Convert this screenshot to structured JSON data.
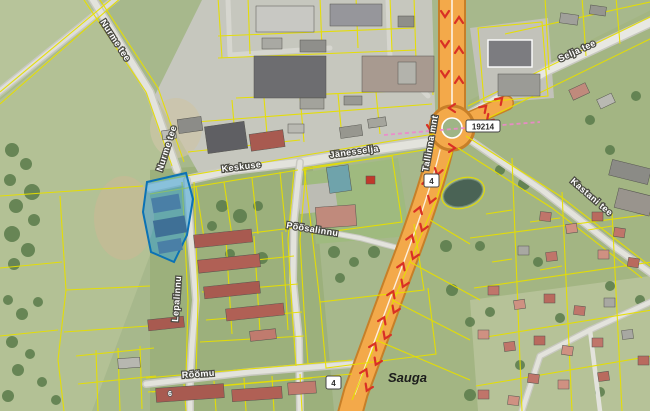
{
  "map": {
    "place_labels": {
      "sauga": "Sauga"
    },
    "streets": {
      "nurme_tee": "Nurme tee",
      "nurme_tee_2": "Nurme tee",
      "keskuse": "Keskuse",
      "janesselja": "Jänesselja",
      "selja_tee": "Selja tee",
      "tallinna_mnt": "Tallinna mnt",
      "kastani_tee": "Kastani tee",
      "lepalinnu": "Lepalinnu",
      "poosalinnu": "Põõsalinnu",
      "roomu": "Rõõmu"
    },
    "road_numbers": {
      "badge_4_north": "4",
      "badge_4_south": "4",
      "badge_19214": "19214"
    },
    "house_numbers": {
      "building_6": "6"
    },
    "icons": {
      "direction_arrows": "red one-way chevron arrows on main road",
      "roundabout": "roundabout junction"
    },
    "colors": {
      "parcel_line": "#e6df00",
      "highlight_fill": "#2f9fd9",
      "highlight_stroke": "#0b72b5",
      "highway_fill": "#f3a94a",
      "highway_casing": "#c77f28",
      "arrow_red": "#d93025",
      "road_fill": "#e3e3dc",
      "pink_boundary": "#ee86cc"
    }
  }
}
